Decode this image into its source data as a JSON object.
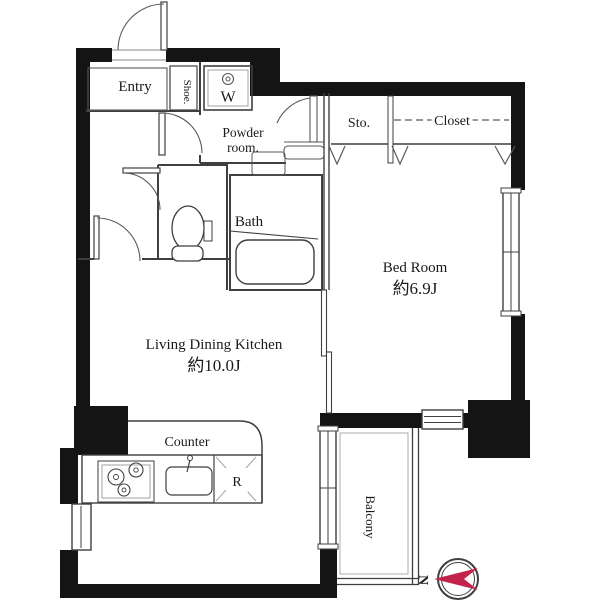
{
  "plan": {
    "type": "apartment-floor-plan",
    "rooms": {
      "entry": {
        "label": "Entry"
      },
      "shoe": {
        "label": "Shoe."
      },
      "washer": {
        "label": "W"
      },
      "powder_room": {
        "label_line1": "Powder",
        "label_line2": "room."
      },
      "storage": {
        "label": "Sto."
      },
      "closet": {
        "label": "Closet"
      },
      "bath": {
        "label": "Bath"
      },
      "bedroom": {
        "label": "Bed Room",
        "size": "約6.9J"
      },
      "ldk": {
        "label": "Living Dining Kitchen",
        "size": "約10.0J"
      },
      "counter": {
        "label": "Counter"
      },
      "refrigerator": {
        "label": "R"
      },
      "balcony": {
        "label": "Balcony"
      }
    },
    "compass": {
      "label": "N"
    },
    "colors": {
      "wall": "#141414",
      "line": "#3f3f3f",
      "fixture_line": "#5a5a5a",
      "text": "#1a1a1a",
      "compass_needle": "#c2234a",
      "background": "#ffffff"
    }
  }
}
